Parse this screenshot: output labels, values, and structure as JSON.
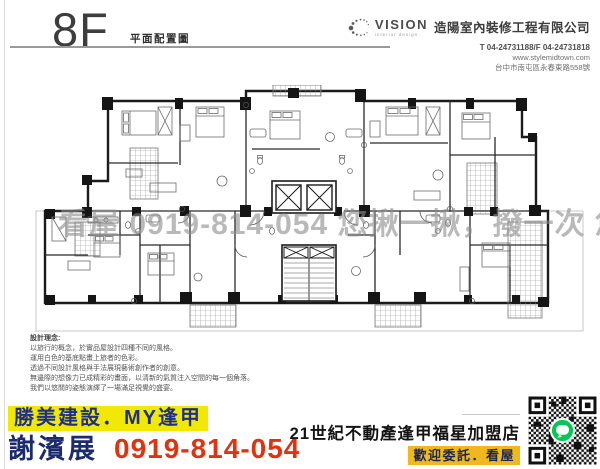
{
  "header": {
    "floor": "8F",
    "subtitle": "平面配置圖"
  },
  "company": {
    "logo_text": "VISION",
    "logo_sub": "interior design",
    "name": "造陽室內裝修工程有限公司",
    "phone": "T 04-24731188/F 04-24731818",
    "website": "www.stylemidtown.com",
    "address": "台中市南屯區永春東路558號"
  },
  "watermark": "看屋 0919-814-054 您揪一揪，撥一次 您我認識",
  "design_notes": {
    "title": "設計理念:",
    "lines": [
      "以旅行的概念，於實品屋設計四種不同的風格。",
      "運用白色的基底點畫上旅者的色彩。",
      "透過不同設計風格與手法展現藝術創作者的創意。",
      "無邊際的想像力已成精彩的畫面，以清新的氣質注入空間的每一個角落。",
      "我們以悠閒的姿態演繹了一場滿足視覺的盛宴。"
    ]
  },
  "footer": {
    "left": {
      "brand": "勝美建設．MY逢甲",
      "agent": "謝濱展",
      "phone": "0919-814-054"
    },
    "right": {
      "store": "21世紀不動產逢甲福星加盟店",
      "welcome": "歡迎委託．看屋"
    }
  },
  "colors": {
    "brand_highlight": "#f1e905",
    "brand_navy": "#1d2f8a",
    "agent_navy": "#1c2a6e",
    "phone_red": "#e03410",
    "welcome_gold": "#efb91d",
    "line_green": "#06c755",
    "watermark_gray": "#8c8c8c"
  }
}
